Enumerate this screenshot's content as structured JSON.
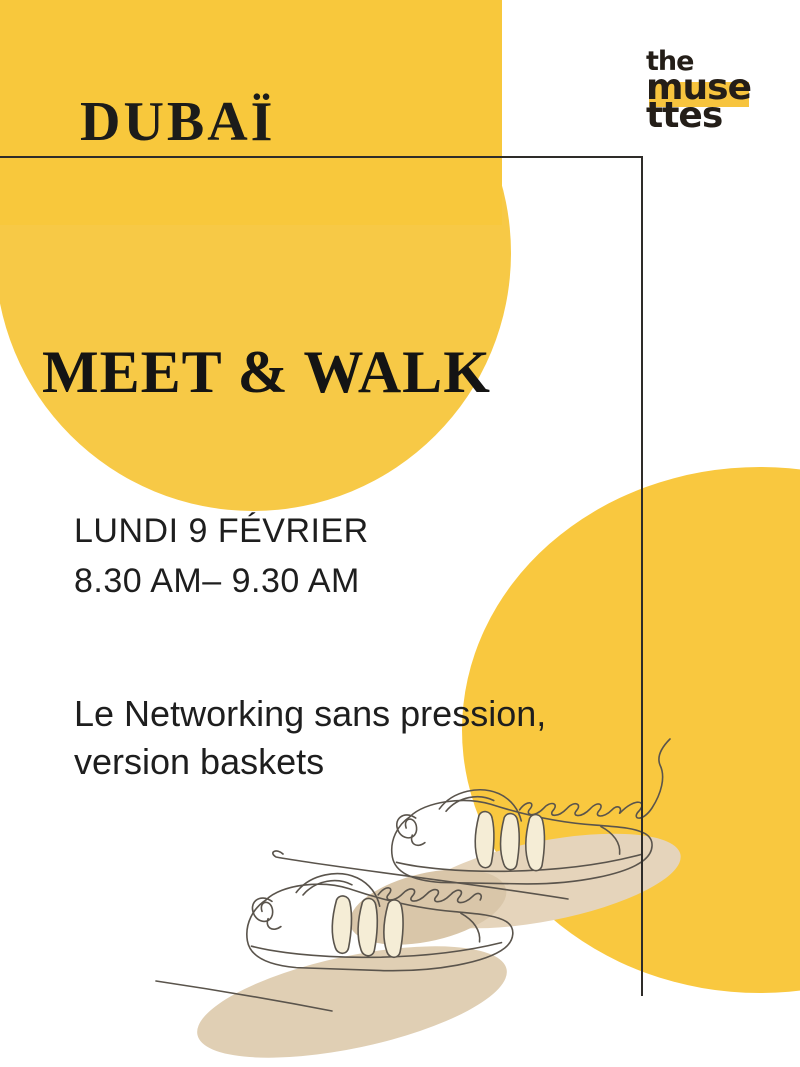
{
  "poster": {
    "location": "DUBAÏ",
    "title": "MEET & WALK",
    "date": "LUNDI 9 FÉVRIER",
    "time": "8.30 AM– 9.30 AM",
    "description_line1": "Le Networking sans pression,",
    "description_line2": "version baskets",
    "logo": {
      "line1": "the",
      "line2": "muse",
      "line3": "ttes"
    },
    "illustration": "sneakers-line-drawing",
    "colors": {
      "yellow_band": "#F8C83C",
      "yellow_circle": "#F7C946",
      "yellow_circle_bottom_right": "#F9C83F",
      "logo_highlight": "#F7C43E",
      "frame_line": "#2E2C29",
      "text_dark": "#1C1C1A",
      "beige_shadow": "#E2D1B6",
      "illustration_line": "#5A544C"
    }
  }
}
